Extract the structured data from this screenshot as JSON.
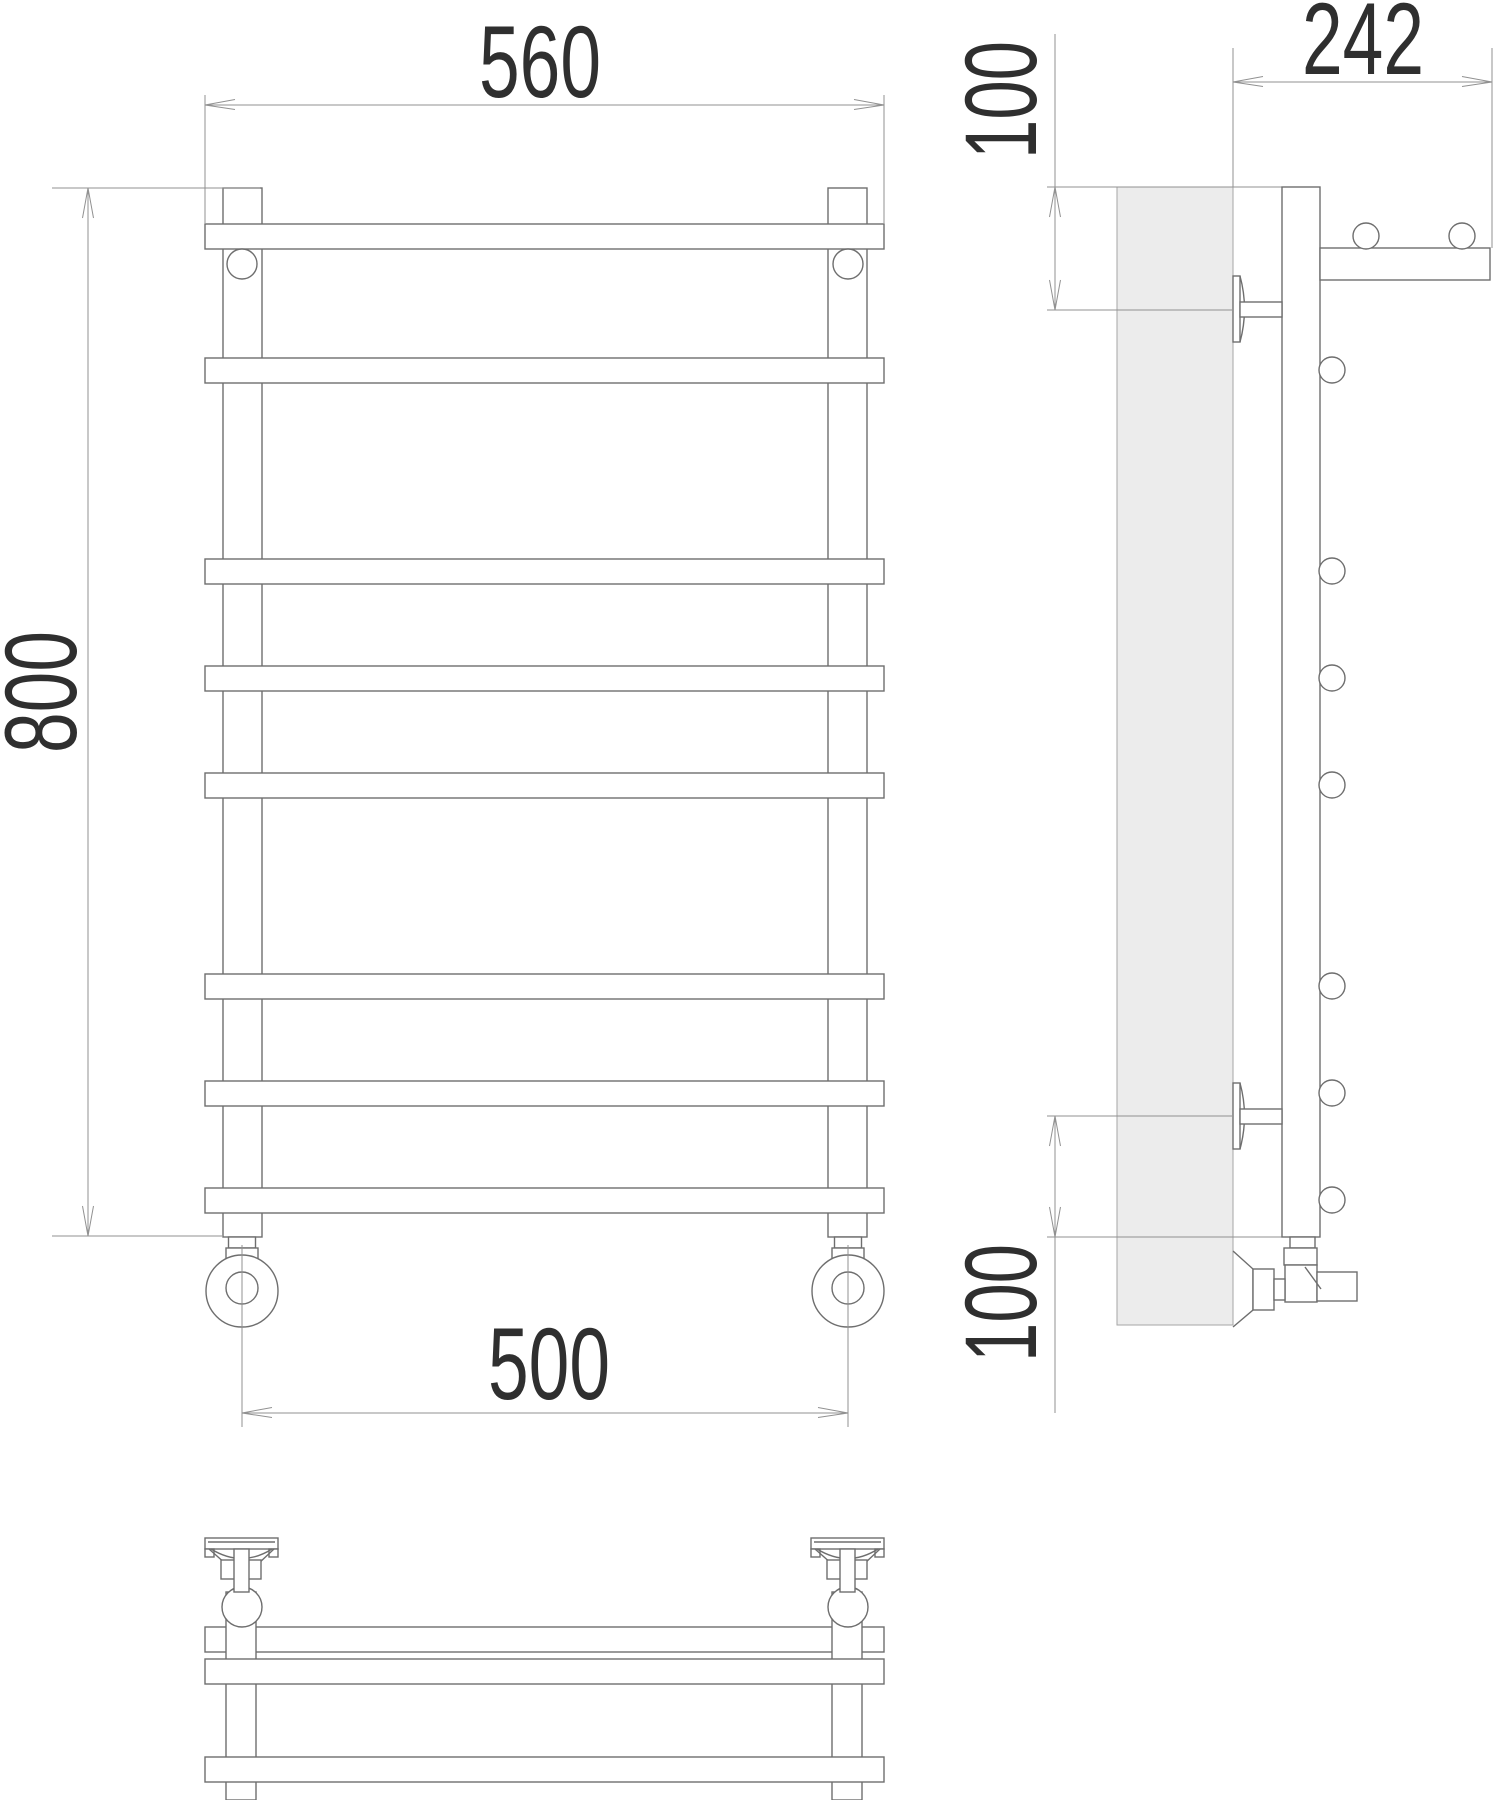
{
  "dimensions": {
    "front_top_width": "560",
    "front_height": "800",
    "front_bottom_width": "500",
    "side_depth": "242",
    "side_top_offset": "100",
    "side_bottom_offset": "100"
  },
  "colors": {
    "line": "#6e6e6e",
    "dimension_line": "#919191",
    "text": "#2f2f2f",
    "wall_fill": "#ececec",
    "background": "#ffffff"
  }
}
